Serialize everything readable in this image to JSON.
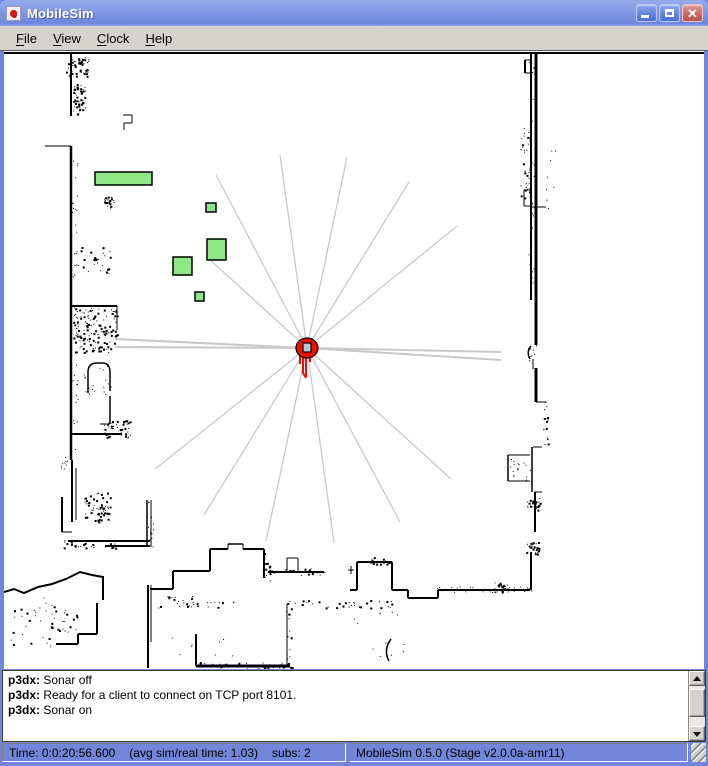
{
  "window": {
    "title": "MobileSim",
    "controls": {
      "minimize": "minimize",
      "maximize": "maximize",
      "close": "close"
    }
  },
  "menubar": {
    "items": [
      {
        "label": "File"
      },
      {
        "label": "View"
      },
      {
        "label": "Clock"
      },
      {
        "label": "Help"
      }
    ]
  },
  "map": {
    "bg": "#ffffff",
    "wall_color": "#000000",
    "ray_color": "#c9c9c9",
    "box_fill": "#90e788",
    "box_stroke": "#000000",
    "robot": {
      "name": "p3dx",
      "x": 307,
      "y": 348,
      "body_color": "#ee0d00",
      "sensor_color": "#b4c7d2",
      "trail": [
        [
          303,
          357,
          303,
          373
        ],
        [
          306,
          357,
          306,
          377
        ],
        [
          300,
          355,
          300,
          364
        ],
        [
          310,
          355,
          310,
          362
        ],
        [
          303,
          373,
          306,
          378
        ]
      ]
    },
    "rays": [
      [
        280,
        155,
        1.3
      ],
      [
        347,
        157,
        1.3
      ],
      [
        216,
        175,
        1.3
      ],
      [
        409,
        182,
        1.3
      ],
      [
        457,
        226,
        1.3
      ],
      [
        208,
        258,
        1.3
      ],
      [
        115,
        339,
        2
      ],
      [
        115,
        347,
        2
      ],
      [
        501,
        352,
        2
      ],
      [
        501,
        360,
        2
      ],
      [
        155,
        469,
        1.3
      ],
      [
        204,
        515,
        1.3
      ],
      [
        266,
        541,
        1.3
      ],
      [
        334,
        543,
        1.3
      ],
      [
        400,
        522,
        1.3
      ],
      [
        451,
        479,
        1.3
      ]
    ],
    "boxes": [
      {
        "x": 95,
        "y": 172,
        "w": 57,
        "h": 13
      },
      {
        "x": 206,
        "y": 203,
        "w": 10,
        "h": 9
      },
      {
        "x": 207,
        "y": 239,
        "w": 19,
        "h": 21
      },
      {
        "x": 173,
        "y": 257,
        "w": 19,
        "h": 18
      },
      {
        "x": 195,
        "y": 292,
        "w": 9,
        "h": 9
      }
    ],
    "walls": [
      [
        4,
        53,
        704,
        53,
        2
      ],
      [
        531,
        53,
        531,
        300,
        2
      ],
      [
        536,
        53,
        536,
        345,
        3
      ],
      [
        525,
        60,
        525,
        73,
        2
      ],
      [
        525,
        60,
        531,
        60,
        1
      ],
      [
        525,
        73,
        531,
        73,
        1
      ],
      [
        524,
        190,
        524,
        206,
        1
      ],
      [
        524,
        190,
        532,
        190,
        1
      ],
      [
        524,
        206,
        532,
        206,
        1
      ],
      [
        530,
        207,
        546,
        207,
        1
      ],
      [
        533,
        359,
        533,
        369,
        1
      ],
      [
        536,
        368,
        536,
        402,
        3
      ],
      [
        536,
        402,
        546,
        402,
        1
      ],
      [
        533,
        447,
        542,
        447,
        1
      ],
      [
        532,
        447,
        532,
        492,
        1.5
      ],
      [
        508,
        455,
        530,
        455,
        1
      ],
      [
        508,
        455,
        508,
        481,
        1.5
      ],
      [
        508,
        481,
        530,
        481,
        1
      ],
      [
        534,
        492,
        542,
        492,
        1
      ],
      [
        535,
        492,
        535,
        532,
        2
      ],
      [
        531,
        552,
        531,
        590,
        2
      ],
      [
        71,
        53,
        71,
        116,
        2
      ],
      [
        45,
        146,
        71,
        146,
        1
      ],
      [
        71,
        146,
        71,
        460,
        2.5
      ],
      [
        72,
        460,
        72,
        522,
        2
      ],
      [
        76,
        468,
        76,
        520,
        1
      ],
      [
        62,
        497,
        62,
        532,
        2
      ],
      [
        62,
        532,
        72,
        532,
        1
      ],
      [
        68,
        541,
        150,
        541,
        2
      ],
      [
        105,
        546,
        150,
        546,
        2
      ],
      [
        72,
        306,
        117,
        306,
        2
      ],
      [
        117,
        306,
        117,
        330,
        1
      ],
      [
        123,
        115,
        132,
        115,
        1
      ],
      [
        132,
        115,
        132,
        123,
        1
      ],
      [
        124,
        123,
        132,
        123,
        1
      ],
      [
        124,
        123,
        124,
        130,
        1
      ],
      [
        72,
        434,
        122,
        434,
        2
      ],
      [
        110,
        396,
        110,
        424,
        1.5
      ],
      [
        100,
        424,
        110,
        424,
        1
      ],
      [
        97,
        603,
        97,
        634,
        2
      ],
      [
        78,
        634,
        97,
        634,
        2
      ],
      [
        78,
        634,
        78,
        644,
        2
      ],
      [
        56,
        644,
        78,
        644,
        2
      ],
      [
        147,
        500,
        147,
        547,
        1.5
      ],
      [
        151,
        500,
        151,
        547,
        1
      ],
      [
        148,
        585,
        148,
        668,
        2
      ],
      [
        151,
        585,
        151,
        642,
        1
      ],
      [
        150,
        589,
        173,
        589,
        2
      ],
      [
        173,
        571,
        173,
        589,
        2
      ],
      [
        173,
        571,
        210,
        571,
        2
      ],
      [
        210,
        549,
        210,
        571,
        2
      ],
      [
        210,
        549,
        228,
        549,
        2
      ],
      [
        228,
        544,
        228,
        549,
        1
      ],
      [
        228,
        544,
        243,
        544,
        1.5
      ],
      [
        243,
        544,
        243,
        549,
        1
      ],
      [
        243,
        549,
        264,
        549,
        2
      ],
      [
        264,
        549,
        264,
        578,
        2
      ],
      [
        268,
        572,
        324,
        572,
        2
      ],
      [
        287,
        558,
        287,
        572,
        1
      ],
      [
        287,
        558,
        298,
        558,
        1
      ],
      [
        298,
        558,
        298,
        572,
        1
      ],
      [
        196,
        634,
        196,
        666,
        2
      ],
      [
        196,
        666,
        290,
        666,
        3
      ],
      [
        287,
        604,
        287,
        666,
        1
      ],
      [
        350,
        590,
        357,
        590,
        2
      ],
      [
        357,
        562,
        357,
        590,
        2
      ],
      [
        357,
        562,
        392,
        562,
        2
      ],
      [
        392,
        562,
        392,
        590,
        2
      ],
      [
        392,
        590,
        408,
        590,
        2
      ],
      [
        408,
        590,
        408,
        598,
        2
      ],
      [
        408,
        598,
        438,
        598,
        2
      ],
      [
        438,
        590,
        438,
        598,
        2
      ],
      [
        438,
        590,
        530,
        590,
        2
      ],
      [
        348,
        570,
        354,
        570,
        1
      ],
      [
        351,
        566,
        351,
        574,
        1
      ]
    ],
    "paths": [
      {
        "d": "M88,393 L88,372 Q88,363 97,363 L102,363 Q110,363 110,372 L110,391",
        "w": 1.5
      },
      {
        "d": "M531,346 Q526,352 530,359",
        "w": 1.5
      },
      {
        "d": "M391,639 Q383,650 389,661",
        "w": 1.5
      },
      {
        "d": "M4,592 L14,589 L24,593 L38,587 L52,584 L66,579 L80,572 L92,575 L103,577 L103,600",
        "w": 2
      }
    ],
    "noise": [
      [
        66,
        56,
        24,
        20,
        50,
        2
      ],
      [
        73,
        84,
        12,
        30,
        45,
        2
      ],
      [
        104,
        194,
        10,
        14,
        22,
        2
      ],
      [
        76,
        245,
        34,
        28,
        28,
        2
      ],
      [
        73,
        308,
        44,
        44,
        130,
        2
      ],
      [
        82,
        360,
        30,
        34,
        22,
        1
      ],
      [
        104,
        420,
        26,
        18,
        45,
        2
      ],
      [
        84,
        492,
        26,
        30,
        60,
        2
      ],
      [
        58,
        455,
        14,
        14,
        10,
        1
      ],
      [
        8,
        596,
        46,
        52,
        28,
        2
      ],
      [
        50,
        608,
        30,
        24,
        20,
        2
      ],
      [
        150,
        596,
        44,
        12,
        18,
        2
      ],
      [
        186,
        601,
        48,
        6,
        16,
        2
      ],
      [
        60,
        540,
        56,
        8,
        25,
        2
      ],
      [
        196,
        662,
        96,
        7,
        40,
        2
      ],
      [
        284,
        600,
        80,
        8,
        18,
        2
      ],
      [
        286,
        606,
        6,
        62,
        18,
        2
      ],
      [
        262,
        552,
        8,
        30,
        16,
        2
      ],
      [
        268,
        568,
        58,
        8,
        22,
        2
      ],
      [
        344,
        600,
        48,
        8,
        16,
        2
      ],
      [
        352,
        610,
        56,
        46,
        12,
        1
      ],
      [
        494,
        582,
        14,
        10,
        26,
        2
      ],
      [
        526,
        542,
        14,
        12,
        26,
        2
      ],
      [
        526,
        498,
        14,
        12,
        26,
        2
      ],
      [
        520,
        128,
        10,
        72,
        30,
        2
      ],
      [
        528,
        60,
        8,
        240,
        40,
        1
      ],
      [
        542,
        150,
        14,
        60,
        8,
        1
      ],
      [
        543,
        402,
        5,
        46,
        16,
        2
      ],
      [
        509,
        456,
        22,
        26,
        18,
        1
      ],
      [
        528,
        345,
        8,
        16,
        10,
        1
      ],
      [
        370,
        556,
        20,
        8,
        14,
        2
      ],
      [
        436,
        586,
        96,
        6,
        30,
        1
      ],
      [
        146,
        498,
        8,
        50,
        12,
        1
      ],
      [
        72,
        150,
        6,
        310,
        40,
        1
      ],
      [
        170,
        634,
        80,
        30,
        8,
        1
      ]
    ]
  },
  "log": {
    "lines": [
      {
        "prefix": "p3dx:",
        "text": "Sonar off"
      },
      {
        "prefix": "p3dx:",
        "text": "Ready for a client to connect on TCP port 8101."
      },
      {
        "prefix": "p3dx:",
        "text": "Sonar on"
      }
    ]
  },
  "status": {
    "time": "Time: 0:0:20:56.600",
    "avg": "(avg sim/real time: 1.03)",
    "subs": "subs: 2",
    "version": "MobileSim 0.5.0 (Stage v2.0.0a-amr11)"
  }
}
